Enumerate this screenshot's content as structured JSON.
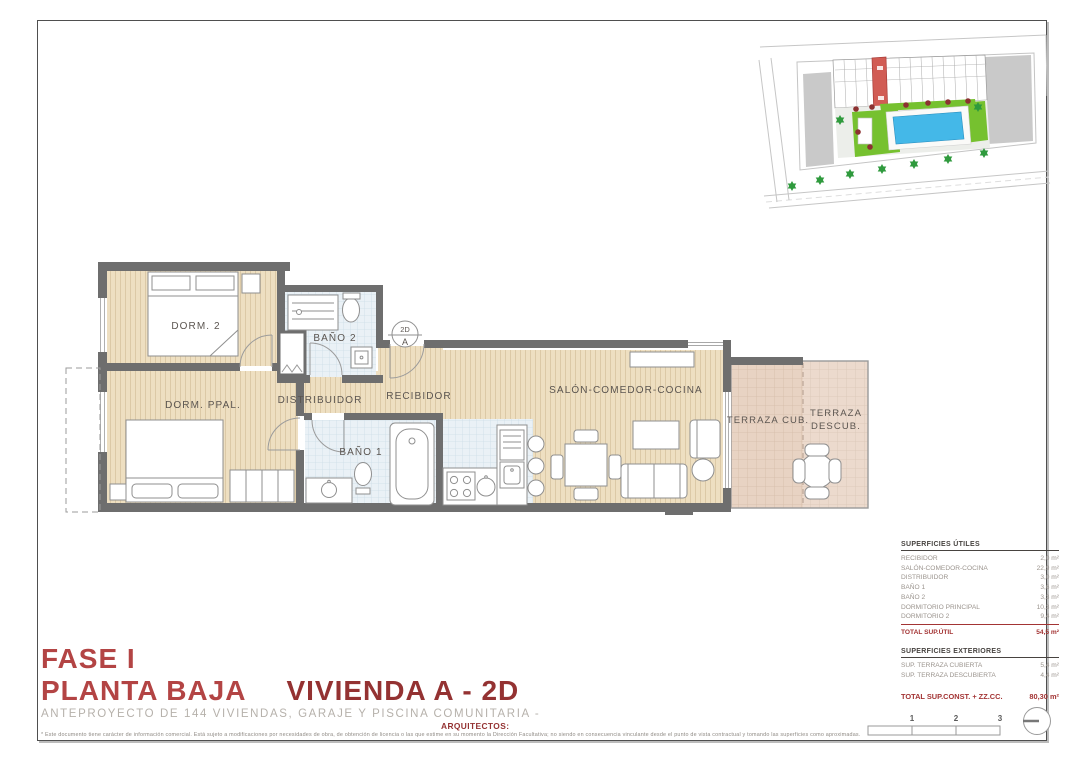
{
  "title_block": {
    "phase": "FASE I",
    "floor": "PLANTA BAJA",
    "unit": "VIVIENDA A - 2D",
    "subtitle": "ANTEPROYECTO DE 144 VIVIENDAS, GARAJE Y PISCINA COMUNITARIA -",
    "architects": "ARQUITECTOS:",
    "disclaimer": "* Este documento tiene carácter de información comercial. Está sujeto a modificaciones por necesidades de obra, de obtención de licencia o las que estime en su momento la Dirección Facultativa; no siendo en consecuencia vinculante desde el punto de vista contractual y tomando las superficies como aproximadas."
  },
  "floor_plan": {
    "rooms": {
      "dorm2": "DORM. 2",
      "bano2": "BAÑO 2",
      "dorm_ppal": "DORM. PPAL.",
      "distribuidor": "DISTRIBUIDOR",
      "recibidor": "RECIBIDOR",
      "bano1": "BAÑO 1",
      "salon": "SALÓN-COMEDOR-COCINA",
      "terraza_cub": "TERRAZA CUB.",
      "terraza_descub_l1": "TERRAZA",
      "terraza_descub_l2": "DESCUB."
    },
    "marker": {
      "top": "2D",
      "bottom": "A"
    }
  },
  "areas_table": {
    "utiles": {
      "title": "SUPERFICIES ÚTILES",
      "rows": [
        {
          "label": "RECIBIDOR",
          "value": "2,0 m²"
        },
        {
          "label": "SALÓN-COMEDOR-COCINA",
          "value": "22,9 m²"
        },
        {
          "label": "DISTRIBUIDOR",
          "value": "3,0 m²"
        },
        {
          "label": "BAÑO 1",
          "value": "3,6 m²"
        },
        {
          "label": "BAÑO 2",
          "value": "3,3 m²"
        },
        {
          "label": "DORMITORIO PRINCIPAL",
          "value": "10,3 m²"
        },
        {
          "label": "DORMITORIO 2",
          "value": "9,4 m²"
        }
      ],
      "total": {
        "label": "TOTAL SUP.ÚTIL",
        "value": "54,5 m²"
      }
    },
    "exteriores": {
      "title": "SUPERFICIES EXTERIORES",
      "rows": [
        {
          "label": "SUP. TERRAZA CUBIERTA",
          "value": "5,4 m²"
        },
        {
          "label": "SUP. TERRAZA DESCUBIERTA",
          "value": "4,4 m²"
        }
      ]
    },
    "grand_total": {
      "label": "TOTAL SUP.CONST. + ZZ.CC.",
      "value": "80,30 m²"
    }
  },
  "scale_bar": {
    "labels": [
      "1",
      "2",
      "3"
    ]
  },
  "colors": {
    "accent_red": "#b34444",
    "accent_maroon": "#943232",
    "wall_gray": "#6e6e6e",
    "wood_floor": "#eedfc1",
    "bath_tile": "#eaf1f6",
    "terrace_tile": "#e8d3c3",
    "site_lawn": "#76c12f",
    "site_pool": "#44b8e8",
    "site_unit_highlight": "#d15c54"
  }
}
